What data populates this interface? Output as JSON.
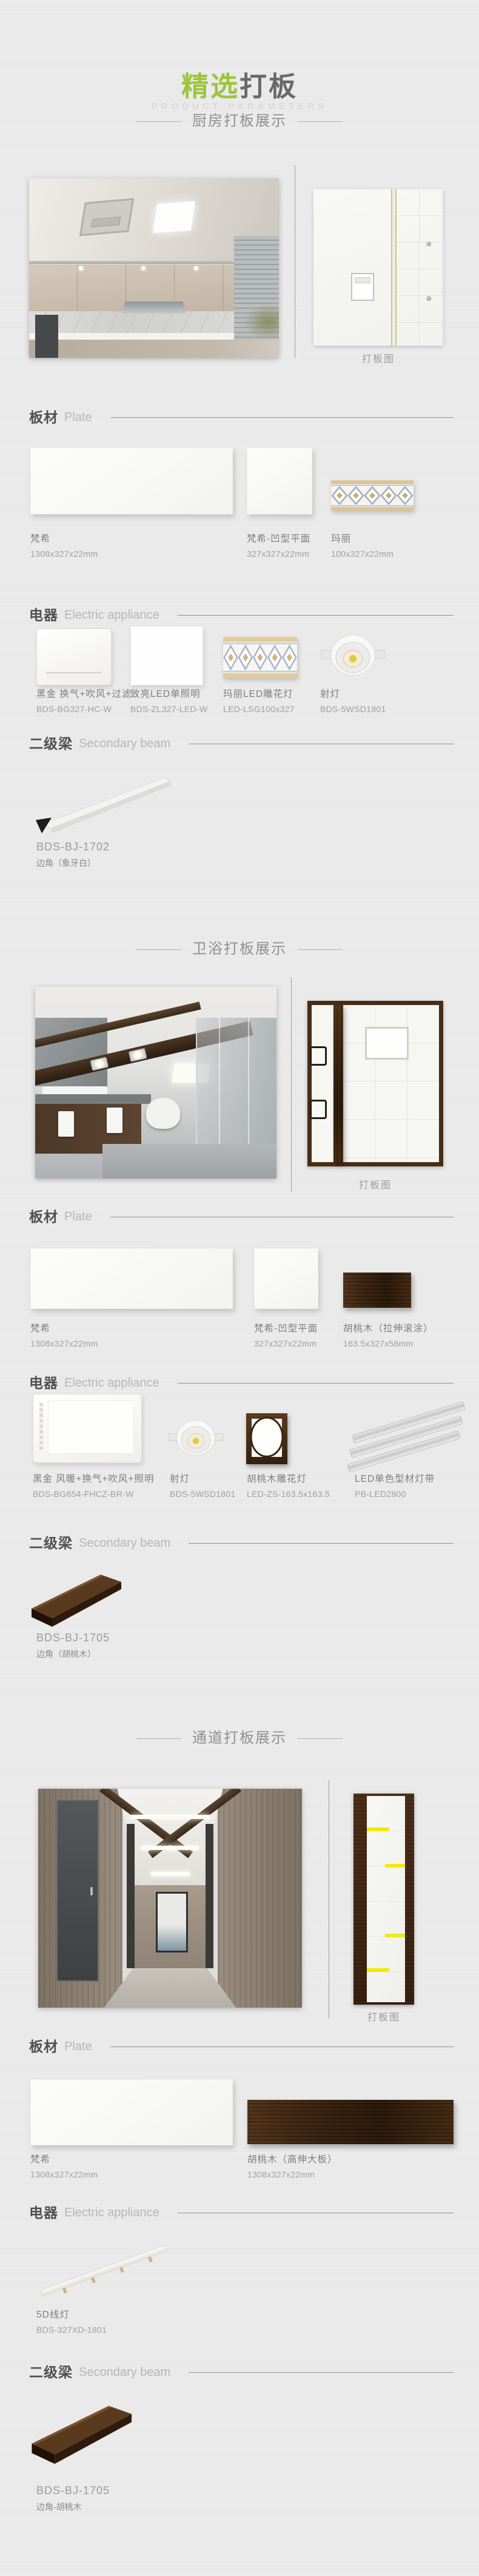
{
  "header": {
    "title_highlight": "精选",
    "title_rest": "打板",
    "subtitle": "PRODUCT PARAMETERS"
  },
  "colors": {
    "accent_green": "#9dc43e",
    "walnut": "#3a2210",
    "stripe_yellow": "#f2ea00"
  },
  "sections": [
    {
      "heading": "厨房打板展示",
      "diagram_caption": "打板图",
      "plate_header": {
        "zh": "板材",
        "en": "Plate"
      },
      "plates": [
        {
          "name": "梵希",
          "size": "1308x327x22mm"
        },
        {
          "name": "梵希-凹型平面",
          "size": "327x327x22mm"
        },
        {
          "name": "玛丽",
          "size": "100x327x22mm"
        }
      ],
      "appliance_header": {
        "zh": "电器",
        "en": "Electric appliance"
      },
      "appliances": [
        {
          "name": "黑金 换气+吹风+过滤",
          "model": "BDS-BG327-HC-W"
        },
        {
          "name": "致亮LED单照明",
          "model": "BDS-ZL327-LED-W"
        },
        {
          "name": "玛丽LED雕花灯",
          "model": "LED-LSG100x327"
        },
        {
          "name": "射灯",
          "model": "BDS-5WSD1801"
        }
      ],
      "beam_header": {
        "zh": "二级梁",
        "en": "Secondary beam"
      },
      "beams": [
        {
          "model": "BDS-BJ-1702",
          "desc": "边角（象牙白）"
        }
      ]
    },
    {
      "heading": "卫浴打板展示",
      "diagram_caption": "打板图",
      "plate_header": {
        "zh": "板材",
        "en": "Plate"
      },
      "plates": [
        {
          "name": "梵希",
          "size": "1308x327x22mm"
        },
        {
          "name": "梵希-凹型平面",
          "size": "327x327x22mm"
        },
        {
          "name": "胡桃木（拉伸滚涂）",
          "size": "163.5x327x58mm"
        }
      ],
      "appliance_header": {
        "zh": "电器",
        "en": "Electric appliance"
      },
      "appliances": [
        {
          "name": "黑金 风暖+换气+吹风+照明",
          "model": "BDS-BG654-FHCZ-BR-W"
        },
        {
          "name": "射灯",
          "model": "BDS-5WSD1801"
        },
        {
          "name": "胡桃木雕花灯",
          "model": "LED-ZS-163.5x163.5"
        },
        {
          "name": "LED单色型材灯带",
          "model": "PB-LED2800"
        }
      ],
      "beam_header": {
        "zh": "二级梁",
        "en": "Secondary beam"
      },
      "beams": [
        {
          "model": "BDS-BJ-1705",
          "desc": "边角（胡桃木）"
        }
      ]
    },
    {
      "heading": "通道打板展示",
      "diagram_caption": "打板图",
      "plate_header": {
        "zh": "板材",
        "en": "Plate"
      },
      "plates": [
        {
          "name": "梵希",
          "size": "1308x327x22mm"
        },
        {
          "name": "胡桃木（高伸大板）",
          "size": "1308x327x22mm"
        }
      ],
      "appliance_header": {
        "zh": "电器",
        "en": "Electric appliance"
      },
      "appliances": [
        {
          "name": "5D线灯",
          "model": "BDS-327XD-1801"
        }
      ],
      "beam_header": {
        "zh": "二级梁",
        "en": "Secondary beam"
      },
      "beams": [
        {
          "model": "BDS-BJ-1705",
          "desc": "边角-胡桃木"
        }
      ]
    }
  ]
}
